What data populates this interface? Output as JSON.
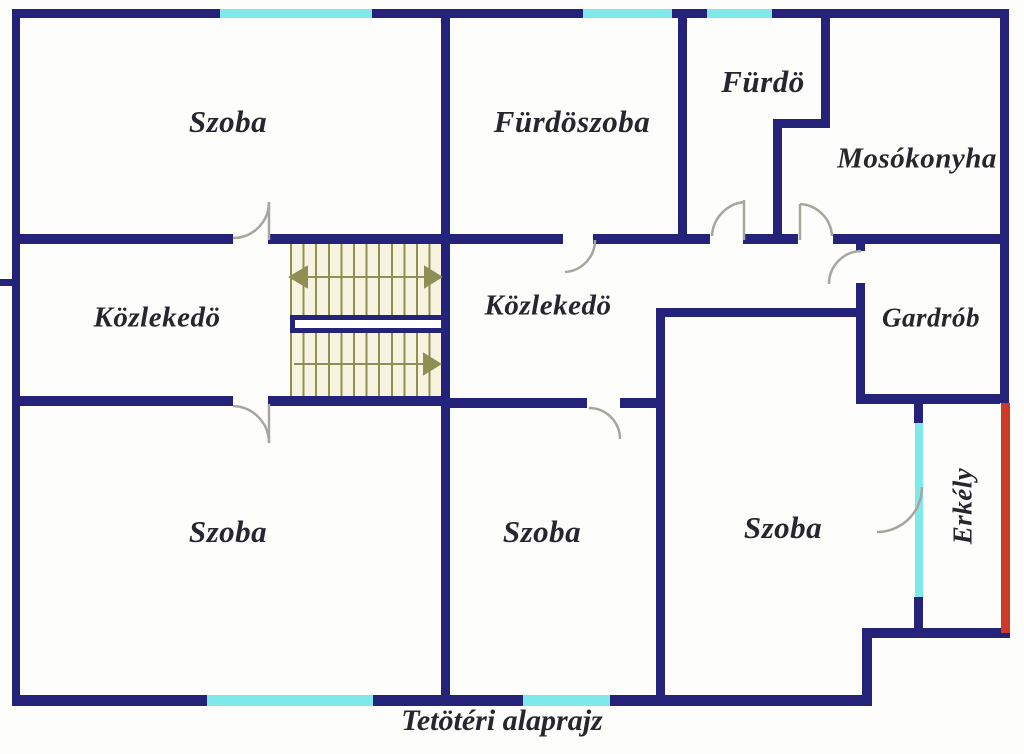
{
  "title": "Tetötéri alaprajz",
  "rooms": [
    {
      "id": "szoba-top-left",
      "label": "Szoba"
    },
    {
      "id": "furdoszoba",
      "label": "Fürdöszoba"
    },
    {
      "id": "furdo",
      "label": "Fürdö"
    },
    {
      "id": "mosokonyha",
      "label": "Mosókonyha"
    },
    {
      "id": "kozlekedo-left",
      "label": "Közlekedö"
    },
    {
      "id": "kozlekedo-center",
      "label": "Közlekedö"
    },
    {
      "id": "gardrob",
      "label": "Gardrób"
    },
    {
      "id": "szoba-bottom-left",
      "label": "Szoba"
    },
    {
      "id": "szoba-bottom-middle",
      "label": "Szoba"
    },
    {
      "id": "szoba-bottom-right",
      "label": "Szoba"
    },
    {
      "id": "erkely",
      "label": "Erkély"
    }
  ],
  "colors": {
    "wall": "#242379",
    "window": "#7fe9ea",
    "balcony_edge": "#cf3a28",
    "stair_lines": "#8f8f55",
    "stair_floor": "#f6f3e0",
    "door_arc": "#a6a69c",
    "label_text": "#26262e",
    "background": "#fdfdfc"
  }
}
